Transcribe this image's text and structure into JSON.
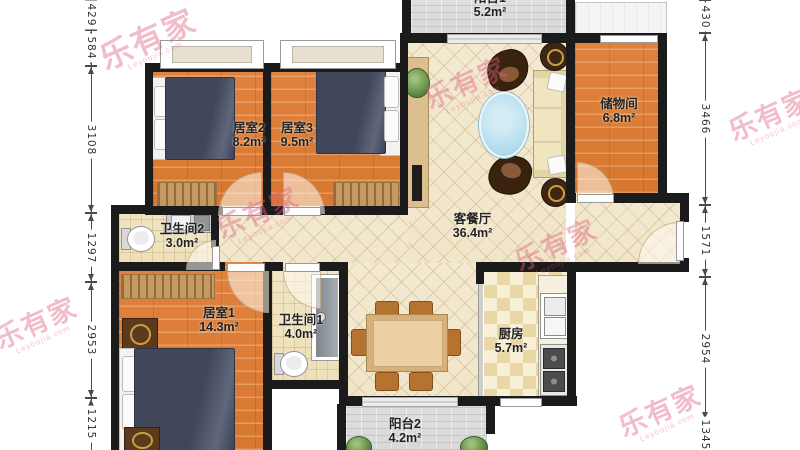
{
  "watermark": {
    "text": "乐有家",
    "subtext": "Leyoujia.com"
  },
  "rooms": {
    "balcony1": {
      "name": "阳台1",
      "area": "5.2m²"
    },
    "bedroom2": {
      "name": "居室2",
      "area": "8.2m²"
    },
    "bedroom3": {
      "name": "居室3",
      "area": "9.5m²"
    },
    "storage": {
      "name": "储物间",
      "area": "6.8m²"
    },
    "living": {
      "name": "客餐厅",
      "area": "36.4m²"
    },
    "bath2": {
      "name": "卫生间2",
      "area": "3.0m²"
    },
    "bedroom1": {
      "name": "居室1",
      "area": "14.3m²"
    },
    "bath1": {
      "name": "卫生间1",
      "area": "4.0m²"
    },
    "kitchen": {
      "name": "厨房",
      "area": "5.7m²"
    },
    "balcony2": {
      "name": "阳台2",
      "area": "4.2m²"
    }
  },
  "dimensions": {
    "left": [
      {
        "value": "429"
      },
      {
        "value": "584"
      },
      {
        "value": "3108"
      },
      {
        "value": "1297"
      },
      {
        "value": "2953"
      },
      {
        "value": "1215"
      }
    ],
    "right": [
      {
        "value": "430"
      },
      {
        "value": "3466"
      },
      {
        "value": "1571"
      },
      {
        "value": "2954"
      },
      {
        "value": "1345"
      }
    ]
  }
}
